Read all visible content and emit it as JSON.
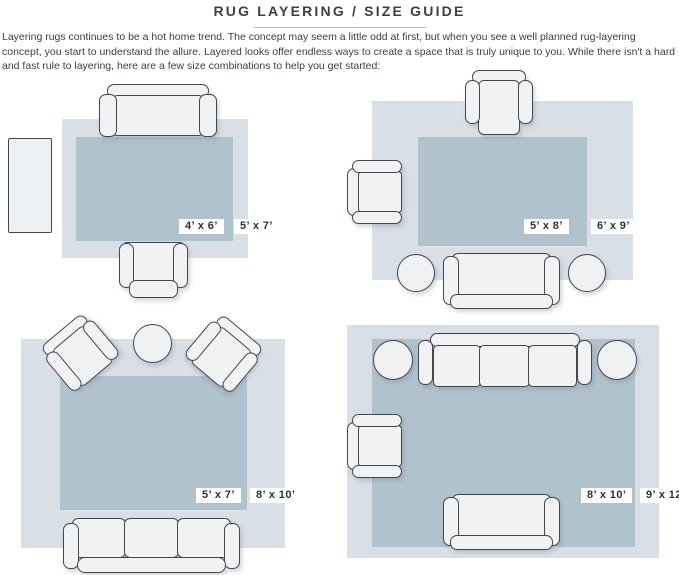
{
  "title": "RUG LAYERING / SIZE GUIDE",
  "intro": "Layering rugs continues to be a hot home trend. The concept may seem a little odd at first, but when you see a well planned rug-layering concept, you start to understand the allure. Layered looks offer endless ways to create a space that is truly unique to you. While there isn't a hard and fast rule to layering, here are a few size combinations to help you get started:",
  "colors": {
    "outer_rug": "#d9dfe7",
    "inner_rug": "#b1c2cf",
    "furniture_fill": "#f0f2f4",
    "furniture_outline": "#42474c",
    "label_text": "#2c3237",
    "label_background": "#ffffff"
  },
  "layouts": [
    {
      "id": "4x6-over-5x7",
      "inner_label": "4’ x 6’",
      "outer_label": "5’ x 7’"
    },
    {
      "id": "5x8-over-6x9",
      "inner_label": "5’ x 8’",
      "outer_label": "6’ x 9’"
    },
    {
      "id": "5x7-over-8x10",
      "inner_label": "5’ x 7’",
      "outer_label": "8’ x 10’"
    },
    {
      "id": "8x10-over-9x12",
      "inner_label": "8’ x 10’",
      "outer_label": "9’ x 12’"
    }
  ]
}
